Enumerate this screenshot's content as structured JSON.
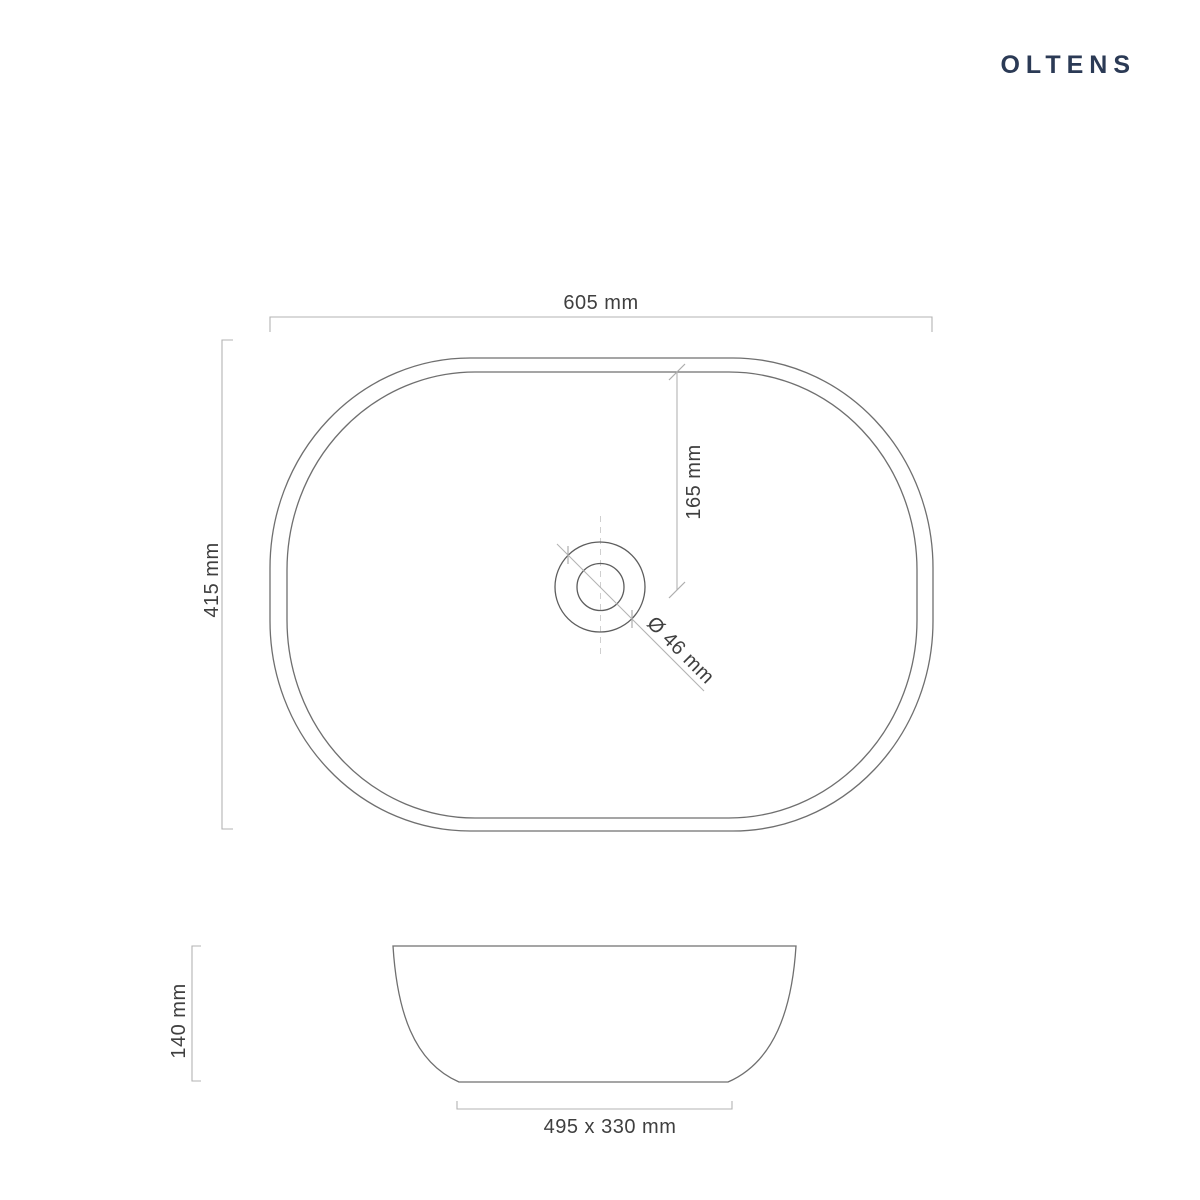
{
  "brand": {
    "name": "OLTENS",
    "color": "#2b3a55"
  },
  "views": {
    "top": {
      "width": "605 mm",
      "height": "415 mm",
      "drain_offset_from_back": "165 mm",
      "drain_diameter": "Ø 46 mm"
    },
    "side": {
      "height": "140 mm",
      "base_dimensions": "495 x 330 mm"
    }
  },
  "style": {
    "background": "#ffffff",
    "outline_color": "#6f6f6f",
    "drain_outline_color": "#5d5d5d",
    "dimension_line_color": "#b3b3b3",
    "centerline_color": "#cfcfcf",
    "dimension_text_color": "#3f3f3f"
  }
}
